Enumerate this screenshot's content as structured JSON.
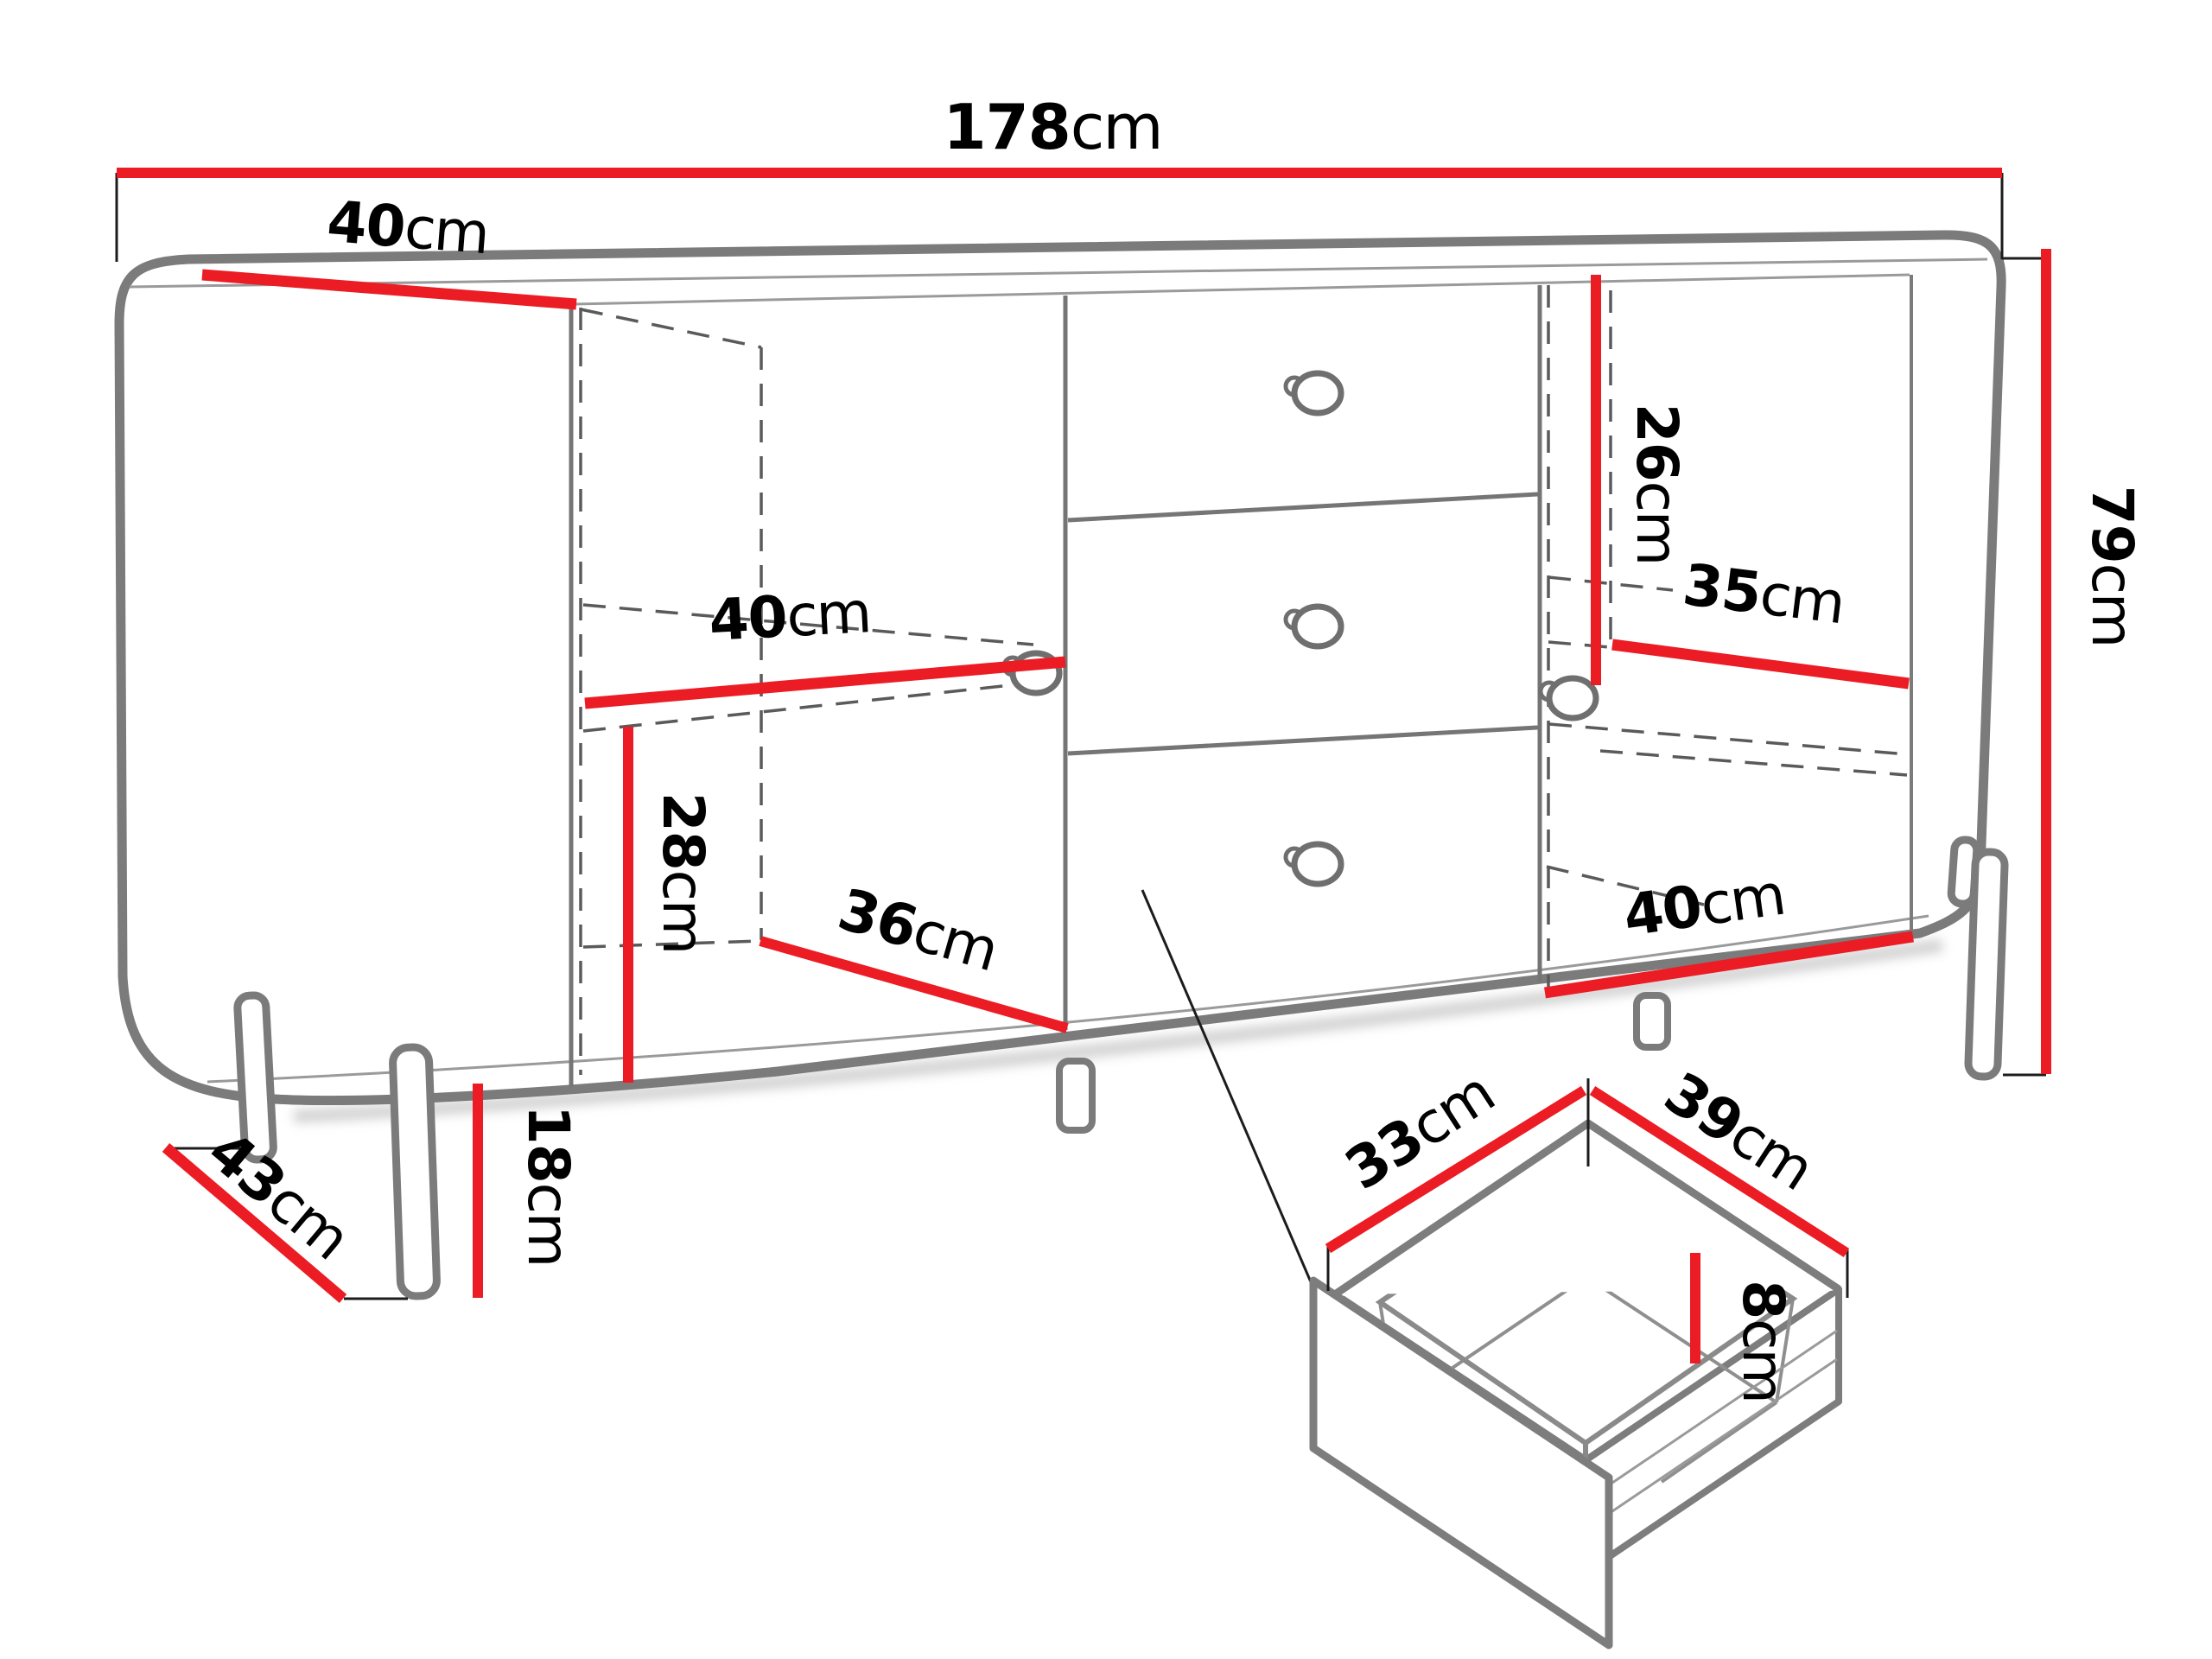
{
  "figure": {
    "type": "furniture-dimension-diagram",
    "subject": "sideboard with two doors, three drawers and drawer detail",
    "units": "cm",
    "counts": {
      "doors": 2,
      "drawers": 3,
      "knobs": 5,
      "legs": 4,
      "shelves": 2
    }
  },
  "colors": {
    "dimension_line": "#ec1c24",
    "outline_gray": "#7b7b7b",
    "dashed_gray": "#5a5a5a",
    "label_black": "#000000",
    "background": "#ffffff"
  },
  "dims": {
    "width_total": {
      "num": "178",
      "unit": "cm"
    },
    "depth_top": {
      "num": "40",
      "unit": "cm"
    },
    "height_total": {
      "num": "79",
      "unit": "cm"
    },
    "right_upper_height": {
      "num": "26",
      "unit": "cm"
    },
    "right_shelf_width": {
      "num": "35",
      "unit": "cm"
    },
    "left_shelf_width": {
      "num": "40",
      "unit": "cm"
    },
    "left_lower_height": {
      "num": "28",
      "unit": "cm"
    },
    "inner_depth": {
      "num": "36",
      "unit": "cm"
    },
    "right_bottom_width": {
      "num": "40",
      "unit": "cm"
    },
    "leg_height": {
      "num": "18",
      "unit": "cm"
    },
    "leg_span_depth": {
      "num": "43",
      "unit": "cm"
    },
    "drawer_inner_depth": {
      "num": "33",
      "unit": "cm"
    },
    "drawer_inner_width": {
      "num": "39",
      "unit": "cm"
    },
    "drawer_inner_height": {
      "num": "8",
      "unit": "cm"
    }
  }
}
